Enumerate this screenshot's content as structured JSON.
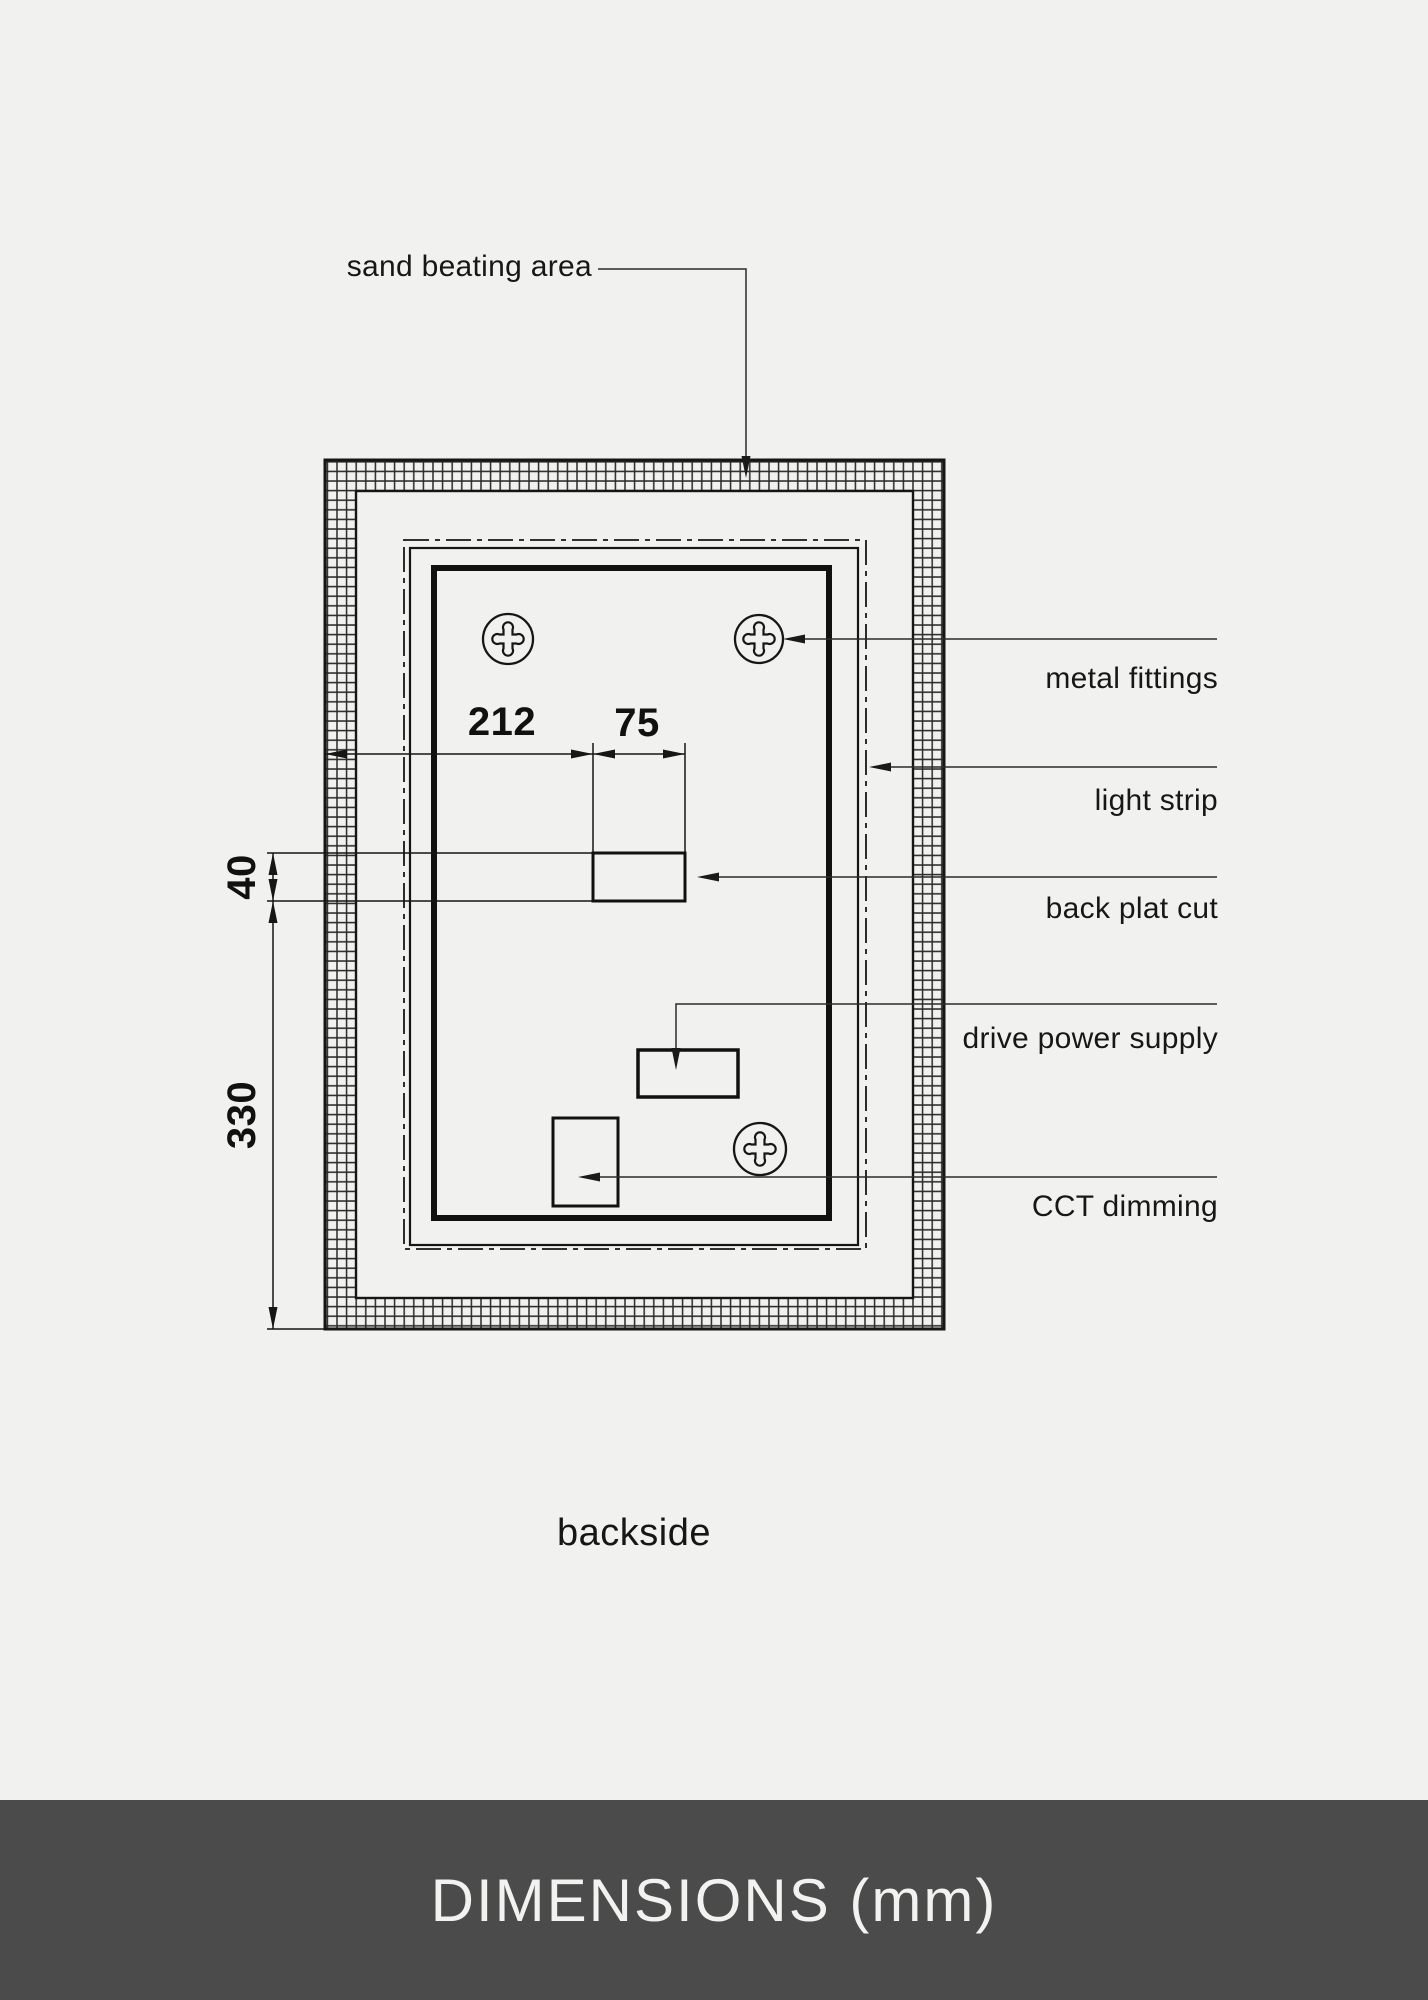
{
  "drawing": {
    "top_callout": "sand beating area",
    "right_callouts": [
      "metal fittings",
      "light strip",
      "back plat cut",
      "drive power supply",
      "CCT dimming"
    ],
    "dimensions": {
      "plate_offset_width": "212",
      "cut_width": "75",
      "cut_height": "40",
      "lower_height": "330"
    },
    "caption": "backside"
  },
  "footer": {
    "title": "DIMENSIONS (mm)"
  },
  "colors": {
    "background": "#f1f1ef",
    "line": "#1a1a1a",
    "footer_background": "#4b4b4b",
    "footer_text": "#f2f2f0"
  }
}
